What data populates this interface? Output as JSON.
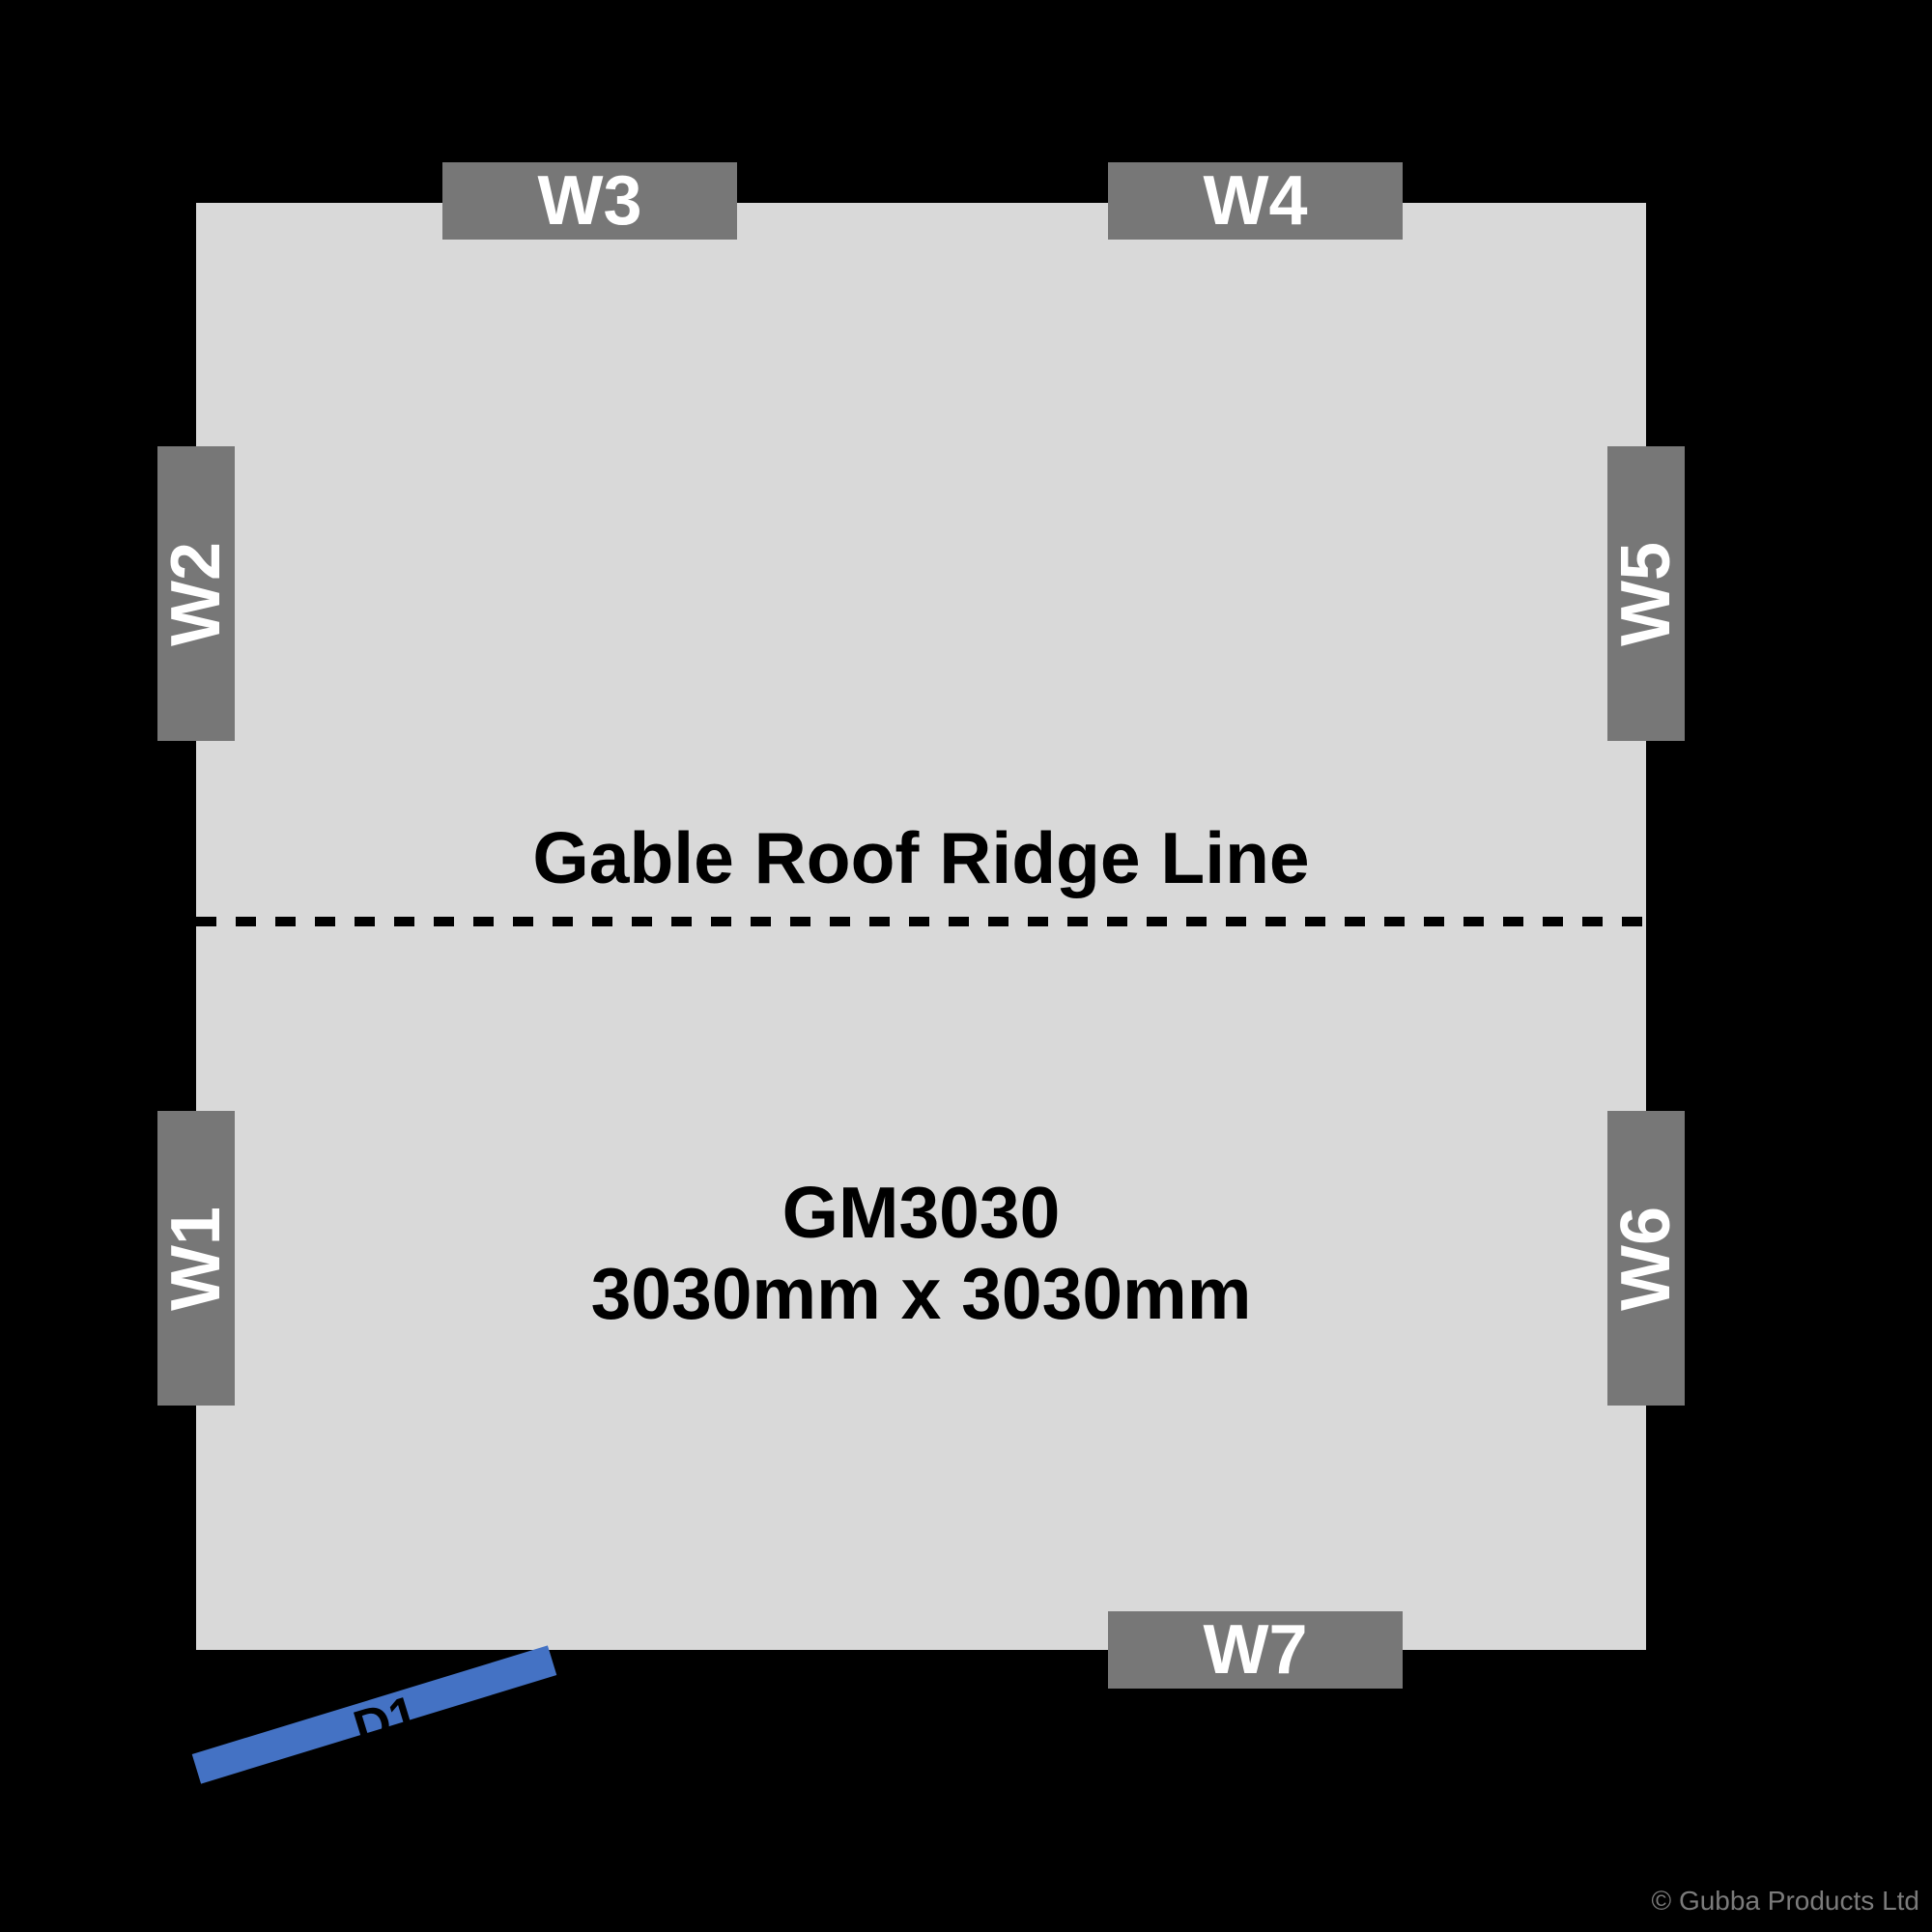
{
  "colors": {
    "background": "#000000",
    "floor": "#D9D9D9",
    "window_marker": "#777777",
    "window_text": "#FFFFFF",
    "door": "#4472C4",
    "ink": "#000000",
    "copyright": "#7B7B7B"
  },
  "plan": {
    "model": "GM3030",
    "size_label": "3030mm x 3030mm",
    "ridge_label": "Gable Roof Ridge Line"
  },
  "windows": [
    {
      "id": "W1",
      "wall": "left"
    },
    {
      "id": "W2",
      "wall": "left"
    },
    {
      "id": "W3",
      "wall": "top"
    },
    {
      "id": "W4",
      "wall": "top"
    },
    {
      "id": "W5",
      "wall": "right"
    },
    {
      "id": "W6",
      "wall": "right"
    },
    {
      "id": "W7",
      "wall": "bottom"
    }
  ],
  "door": {
    "id": "D1",
    "wall": "bottom-left"
  },
  "footer": {
    "copyright": "© Gubba Products Ltd"
  }
}
